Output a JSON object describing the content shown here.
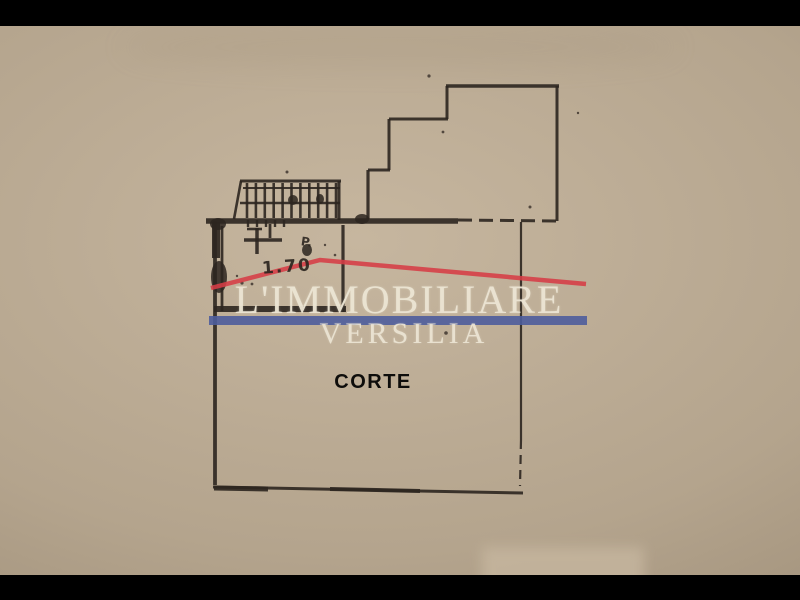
{
  "background": {
    "paper_base": "#b4a48d",
    "paper_light": "#c6b69f",
    "paper_dark": "#988872",
    "letterbox_color": "#000000"
  },
  "watermark": {
    "line1": "L'IMMOBILIARE",
    "line2": "VERSILIA",
    "text_color": "#ece5d4",
    "bar_color": "#4e5d9c",
    "roof_color": "#d63c45",
    "roof_points": [
      [
        211,
        288
      ],
      [
        320,
        260
      ],
      [
        586,
        284
      ]
    ]
  },
  "plan": {
    "label": "CORTE",
    "label_color": "#0e0d0b",
    "annotation": "1.70",
    "annotation_mark": "P.",
    "line_color": "#2d2620",
    "segments": [
      [
        446,
        86,
        559,
        86,
        3.5,
        ""
      ],
      [
        557,
        86,
        557,
        221,
        3,
        ""
      ],
      [
        447,
        86,
        447,
        119,
        3,
        ""
      ],
      [
        448,
        119,
        389,
        119,
        3,
        ""
      ],
      [
        389,
        119,
        389,
        170,
        3,
        ""
      ],
      [
        390,
        170,
        368,
        170,
        3,
        ""
      ],
      [
        368,
        170,
        368,
        219,
        3.2,
        ""
      ],
      [
        206,
        221,
        458,
        221,
        5.5,
        ""
      ],
      [
        458,
        220,
        558,
        221,
        3,
        "14,7"
      ],
      [
        521,
        222,
        521,
        440,
        2.2,
        ""
      ],
      [
        521,
        440,
        520,
        486,
        2.2,
        "9,6"
      ],
      [
        213,
        487,
        523,
        493,
        3,
        ""
      ],
      [
        214,
        488,
        268,
        489,
        5,
        ""
      ],
      [
        330,
        489,
        420,
        491,
        4,
        ""
      ],
      [
        215,
        221,
        215,
        485,
        3.8,
        ""
      ],
      [
        216,
        222,
        216,
        258,
        8,
        ""
      ],
      [
        222,
        226,
        222,
        311,
        2.8,
        ""
      ],
      [
        343,
        225,
        343,
        312,
        3.2,
        ""
      ],
      [
        214,
        309,
        346,
        309,
        6,
        ""
      ],
      [
        240,
        181,
        341,
        181,
        3,
        ""
      ],
      [
        243,
        188,
        340,
        188,
        2,
        ""
      ],
      [
        240,
        203,
        340,
        203,
        2.6,
        ""
      ],
      [
        339,
        181,
        339,
        220,
        3,
        ""
      ],
      [
        241,
        181,
        234,
        219,
        2.6,
        ""
      ],
      [
        244,
        240,
        282,
        240,
        3.5,
        ""
      ],
      [
        257,
        228,
        257,
        254,
        3.5,
        ""
      ],
      [
        270,
        224,
        270,
        238,
        2.8,
        ""
      ],
      [
        247,
        229,
        262,
        229,
        2.6,
        ""
      ]
    ],
    "treads": {
      "x1": 247,
      "x2": 336,
      "count": 11,
      "y1": 183,
      "y2": 218,
      "w": 2.6
    },
    "room_treads": {
      "x1": 248,
      "x2": 284,
      "count": 5,
      "y1": 220,
      "y2": 227,
      "w": 2.4
    },
    "blobs": [
      [
        219,
        277,
        8,
        16
      ],
      [
        307,
        250,
        5,
        6
      ],
      [
        362,
        219,
        7,
        5
      ],
      [
        218,
        224,
        8,
        6
      ],
      [
        293,
        200,
        5,
        5
      ],
      [
        320,
        199,
        4,
        5
      ]
    ],
    "specks": [
      [
        429,
        76,
        1.6
      ],
      [
        443,
        132,
        1.4
      ],
      [
        530,
        207,
        1.5
      ],
      [
        287,
        172,
        1.5
      ],
      [
        446,
        333,
        1.8
      ],
      [
        578,
        113,
        1.2
      ],
      [
        237,
        276,
        1.2
      ],
      [
        242,
        283,
        1.6
      ],
      [
        252,
        284,
        1.4
      ],
      [
        335,
        255,
        1.3
      ],
      [
        325,
        245,
        1.2
      ]
    ]
  }
}
